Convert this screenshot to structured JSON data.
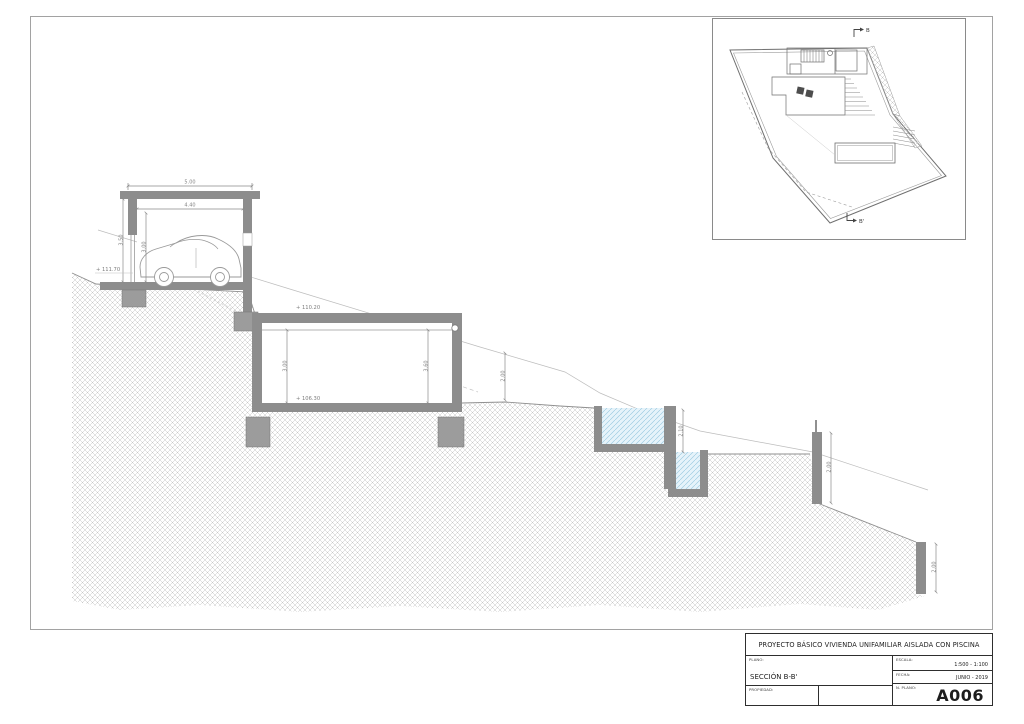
{
  "title_block": {
    "project_title": "PROYECTO BÁSICO VIVIENDA UNIFAMILIAR AISLADA CON PISCINA",
    "plano": {
      "label": "PLANO:",
      "value": "SECCIÓN B-B'"
    },
    "escala": {
      "label": "ESCALA:",
      "value": "1:500 - 1:100"
    },
    "fecha": {
      "label": "FECHA:",
      "value": "JUNIO - 2019"
    },
    "propiedad": {
      "label": "PROPIEDAD:"
    },
    "n_plano": {
      "label": "N. PLANO:",
      "value": "A006"
    }
  },
  "section_drawing": {
    "dimensions": {
      "garage_width": "5.00",
      "garage_clear_width": "4.40",
      "garage_height": "3.50",
      "garage_clear_height": "3.00",
      "house_clear_height_left": "3.00",
      "house_clear_height_right": "3.60",
      "terrain_cut_height": "2.00",
      "pool_depth": "2.10",
      "retaining_wall_height": "2.00",
      "lower_wall_height": "2.00"
    },
    "levels": {
      "garage_floor": "+ 111.70",
      "house_roof": "+ 110.20",
      "house_floor": "+ 106.30"
    }
  },
  "site_plan": {
    "section_mark_start": "B",
    "section_mark_end": "B'"
  },
  "colors": {
    "concrete": "#8d8d8d",
    "terrain_hatch": "#c6c6c6",
    "water_fill": "#e6f3fa",
    "water_hatch": "#93c5dd",
    "dimension": "#8a8a8a"
  }
}
